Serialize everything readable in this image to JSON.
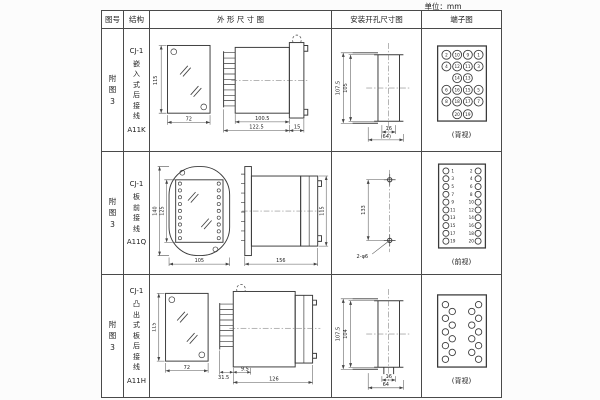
{
  "unit_label": "单位：mm",
  "header": {
    "fig": "图号",
    "structure": "结构",
    "outline": "外 形 尺 寸 图",
    "mounting": "安装开孔尺寸图",
    "terminal": "端子图"
  },
  "rows": [
    {
      "fig_no": "附图3",
      "structure": {
        "model": "CJ-1",
        "name": "嵌入式后接线",
        "code": "A11K"
      },
      "outline": {
        "front_height": "115",
        "front_width": "72",
        "body_depth": "100.5",
        "total_depth": "122.5",
        "flange_depth": "15"
      },
      "mounting": {
        "outer_height": "107.5",
        "inner_height": "105",
        "slot_width": "16",
        "overall_width": "(64)"
      },
      "terminal": {
        "caption": "(背视)",
        "layout": [
          [
            "2",
            "10",
            "9",
            "1"
          ],
          [
            "4",
            "12",
            "11",
            "3"
          ],
          [
            "",
            "14",
            "13",
            ""
          ],
          [
            "6",
            "16",
            "15",
            "5"
          ],
          [
            "8",
            "18",
            "17",
            "7"
          ],
          [
            "",
            "20",
            "19",
            ""
          ]
        ]
      }
    },
    {
      "fig_no": "附图3",
      "structure": {
        "model": "CJ-1",
        "name": "板前接线",
        "code": "A11Q"
      },
      "outline": {
        "front_outer_height": "140",
        "front_inner_height": "125",
        "front_width": "105",
        "side_length": "156",
        "side_height": "115"
      },
      "mounting": {
        "hole_spacing": "133",
        "holes_label": "2-φ6"
      },
      "terminal": {
        "caption": "(前视)",
        "left": [
          "1",
          "3",
          "5",
          "7",
          "9",
          "11",
          "13",
          "15",
          "17",
          "19"
        ],
        "right": [
          "2",
          "4",
          "6",
          "8",
          "10",
          "12",
          "14",
          "16",
          "18",
          "20"
        ]
      }
    },
    {
      "fig_no": "附图3",
      "structure": {
        "model": "CJ-1",
        "name": "凸出式板后接线",
        "code": "A11H"
      },
      "outline": {
        "front_height": "115",
        "front_width": "72",
        "pin_depth": "31.5",
        "stub_depth": "9.5",
        "body_depth": "126"
      },
      "mounting": {
        "outer_height": "107.5",
        "inner_height": "104",
        "slot_width": "16",
        "overall_width": "64"
      },
      "terminal": {
        "caption": "(背视)",
        "style": "staggered"
      }
    }
  ]
}
